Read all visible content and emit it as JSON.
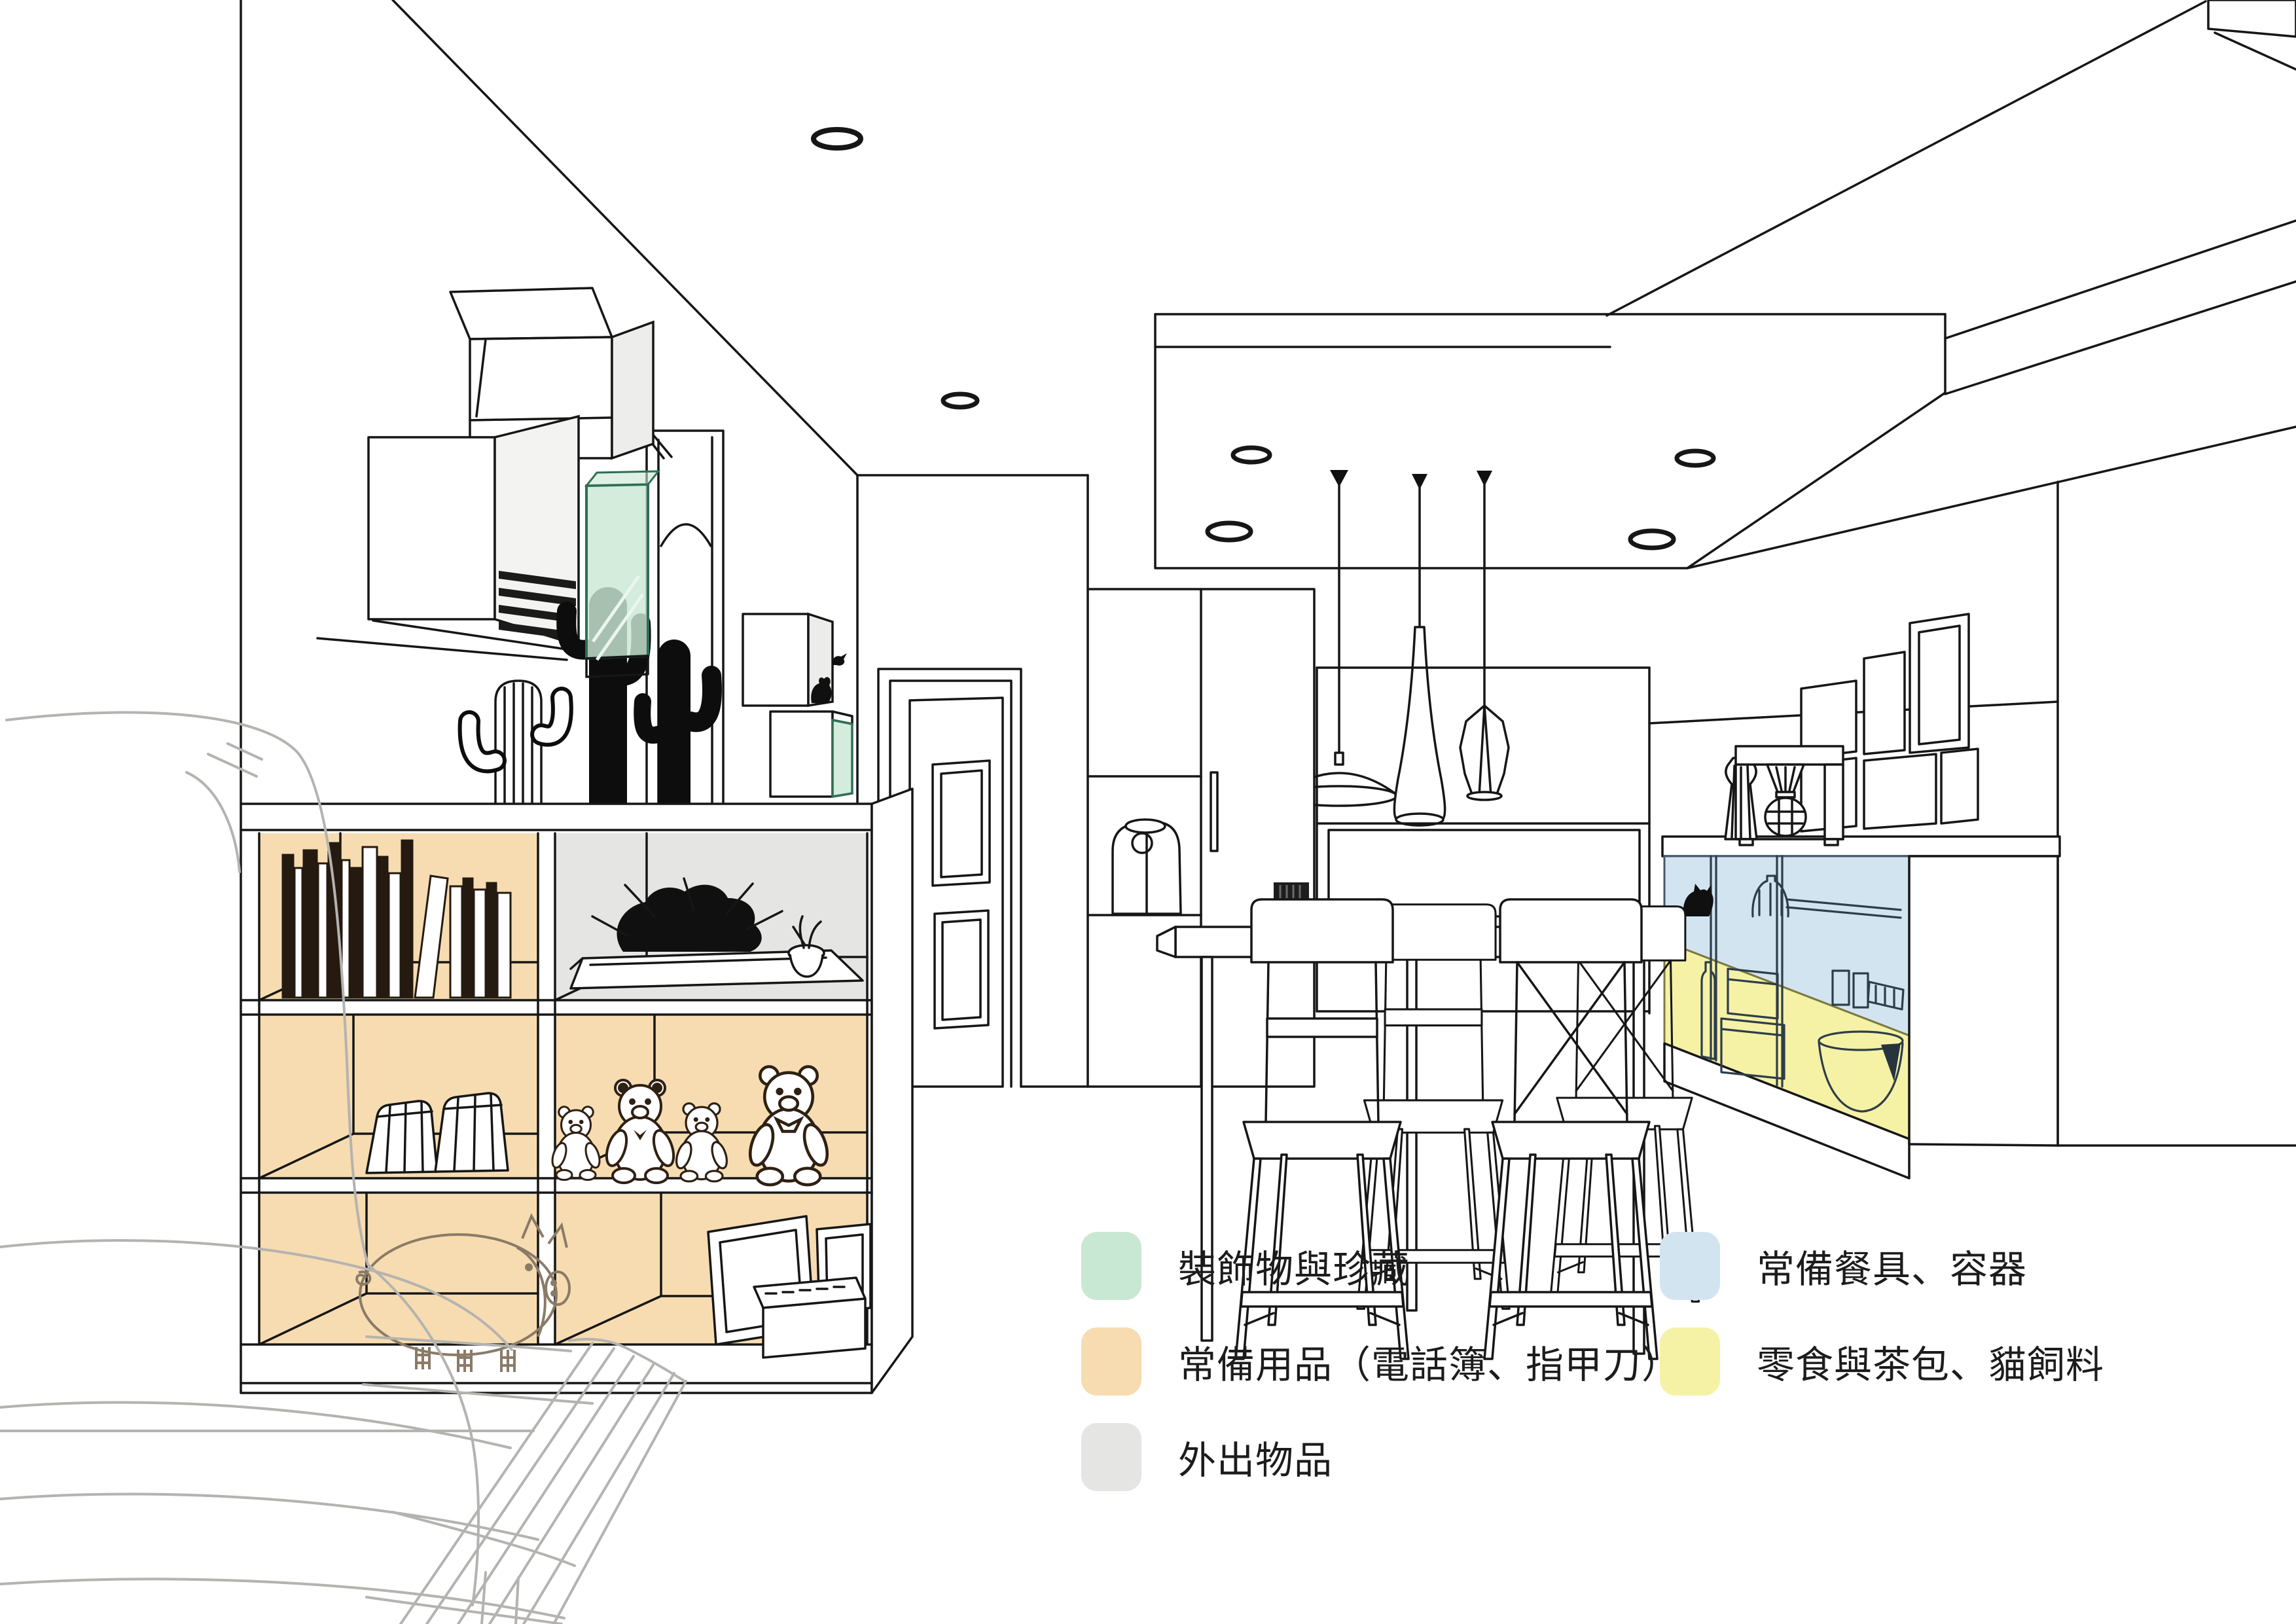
{
  "legend": {
    "left_column": [
      {
        "id": "green",
        "color": "#c9e8d3",
        "label": "裝飾物與珍藏"
      },
      {
        "id": "orange",
        "color": "#f6dcb0",
        "label": "常備用品（電話簿、指甲刀）"
      },
      {
        "id": "gray",
        "color": "#e5e5e4",
        "label": "外出物品"
      }
    ],
    "right_column": [
      {
        "id": "blue",
        "color": "#d3e4f1",
        "label": "常備餐具、容器"
      },
      {
        "id": "yellow",
        "color": "#f5f2a6",
        "label": "零食與茶包、貓飼料"
      }
    ]
  },
  "line_color": "#161616"
}
